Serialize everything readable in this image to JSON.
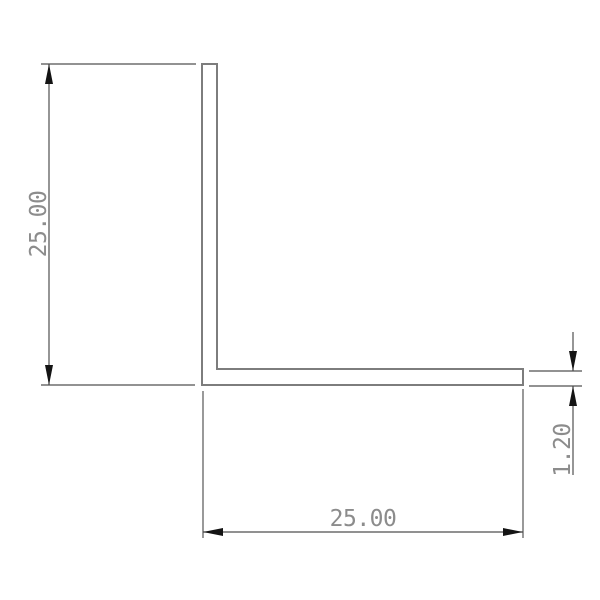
{
  "drawing": {
    "shape": "L-angle-profile-cross-section",
    "dimensions": [
      {
        "id": "height",
        "label": "25.00",
        "orientation": "vertical",
        "position": "left"
      },
      {
        "id": "width",
        "label": "25.00",
        "orientation": "horizontal",
        "position": "bottom"
      },
      {
        "id": "thickness",
        "label": "1.20",
        "orientation": "vertical",
        "position": "right"
      }
    ]
  },
  "colors": {
    "background": "#ffffff",
    "profile_line": "#7d7d7d",
    "extension_line": "#6e6e6e",
    "dimension_line": "#4f4f4f",
    "arrow": "#141414",
    "text": "#8c8c8c"
  }
}
